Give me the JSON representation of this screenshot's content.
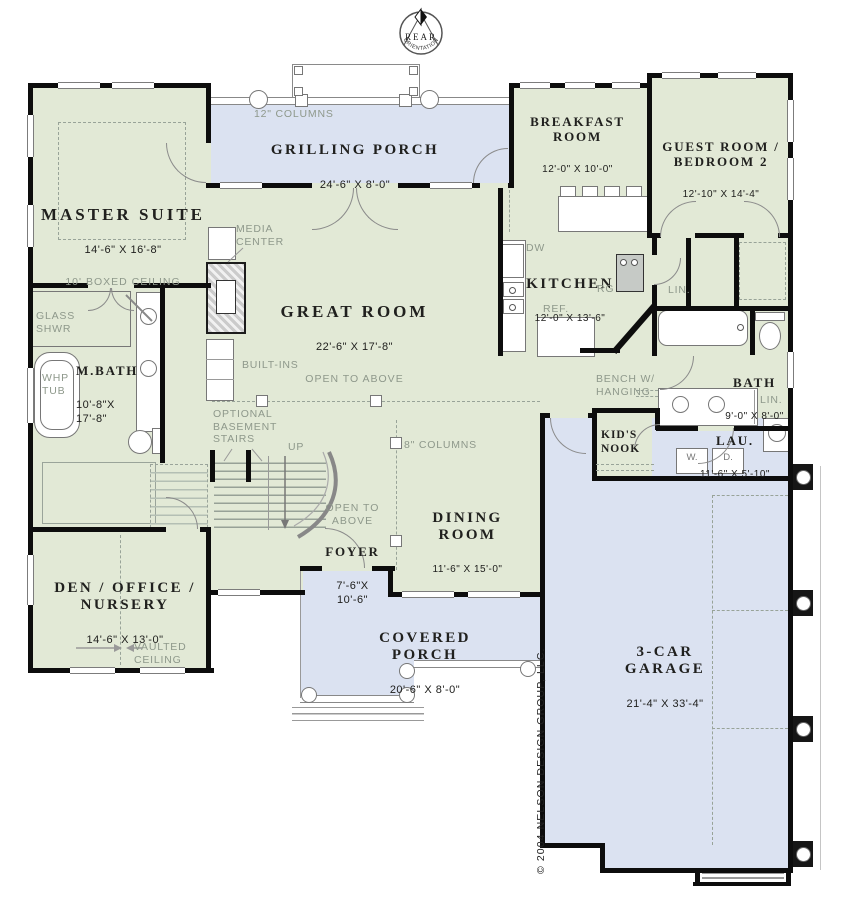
{
  "compass": {
    "top": "REAR",
    "bottom": "ORIENTATION"
  },
  "colors": {
    "floor_green": "#e2e9d6",
    "porch_blue": "#dbe2f1",
    "wall_black": "#0d0d0d",
    "text_dark": "#20201e",
    "text_muted": "#8e988b"
  },
  "rooms": {
    "master": {
      "name": "MASTER SUITE",
      "dims": "14'-6\" X 16'-8\"",
      "note": "10' BOXED CEILING"
    },
    "grilling_porch": {
      "name": "GRILLING PORCH",
      "dims": "24'-6\" X 8'-0\""
    },
    "breakfast": {
      "name": "BREAKFAST\nROOM",
      "dims": "12'-0\" X 10'-0\""
    },
    "guest": {
      "name": "GUEST ROOM /\nBEDROOM 2",
      "dims": "12'-10\" X 14'-4\""
    },
    "kitchen": {
      "name": "KITCHEN",
      "dims": "12'-0\" X 13'-6\""
    },
    "great": {
      "name": "GREAT ROOM",
      "dims": "22'-6\" X 17'-8\"",
      "note": "OPEN TO ABOVE"
    },
    "mbath": {
      "name": "M.BATH",
      "dims": "10'-8\"X\n17'-8\""
    },
    "bath": {
      "name": "BATH",
      "dims": "9'-0\" X 8'-0\""
    },
    "laundry": {
      "name": "LAU.",
      "dims": "11'-6\" X 5'-10\""
    },
    "kids_nook": {
      "name": "KID'S\nNOOK"
    },
    "foyer": {
      "name": "FOYER",
      "dims": "7'-6\"X\n10'-6\"",
      "note": "OPEN TO\nABOVE"
    },
    "dining": {
      "name": "DINING\nROOM",
      "dims": "11'-6\" X 15'-0\""
    },
    "den": {
      "name": "DEN / OFFICE /\nNURSERY",
      "dims": "14'-6\" X 13'-0\"",
      "note": "VAULTED\nCEILING"
    },
    "covered_porch": {
      "name": "COVERED PORCH",
      "dims": "20'-6\" X 8'-0\""
    },
    "garage": {
      "name": "3-CAR\nGARAGE",
      "dims": "21'-4\" X 33'-4\""
    }
  },
  "annotations": {
    "columns12": "12\" COLUMNS",
    "columns8": "8\" COLUMNS",
    "media_center": "MEDIA\nCENTER",
    "built_ins": "BUILT-INS",
    "optional_basement": "OPTIONAL\nBASEMENT\nSTAIRS",
    "up": "UP",
    "glass_shwr": "GLASS\nSHWR",
    "whp_tub": "WHP\nTUB",
    "dw": "DW",
    "rg": "RG",
    "ref": "REF.",
    "lin_hall": "LIN.",
    "lin_bath": "LIN.",
    "bench": "BENCH W/\nHANGING",
    "washer": "W.",
    "dryer": "D.",
    "copyright": "© 2004 NELSON DESIGN GROUP, LLC."
  }
}
